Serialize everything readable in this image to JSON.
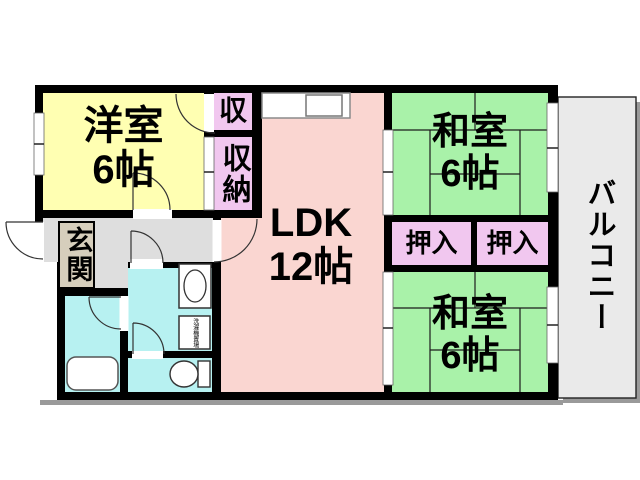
{
  "floorplan": {
    "western_room": {
      "label": "洋室",
      "size": "6帖"
    },
    "ldk": {
      "label": "LDK",
      "size": "12帖"
    },
    "japanese_room_upper": {
      "label": "和室",
      "size": "6帖"
    },
    "japanese_room_lower": {
      "label": "和室",
      "size": "6帖"
    },
    "closet_small": {
      "label": "収"
    },
    "closet_tall": {
      "label": "収納"
    },
    "oshiire_left": {
      "label": "押入"
    },
    "oshiire_right": {
      "label": "押入"
    },
    "entrance": {
      "label": "玄関"
    },
    "balcony": {
      "label": "バルコニー"
    },
    "laundry_box": {
      "label": "洗濯機置場"
    }
  },
  "colors": {
    "wall": "#000000",
    "western_room": "#FFFFB2",
    "ldk": "#FAD6D1",
    "japanese_room": "#A9F2A9",
    "closet": "#F1C7EF",
    "wet_area": "#B7F1F1",
    "hallway": "#DEDEDE",
    "entrance_floor": "#D6CEBC",
    "balcony": "#EAEAEA",
    "shadow": "#9A9A9A"
  }
}
